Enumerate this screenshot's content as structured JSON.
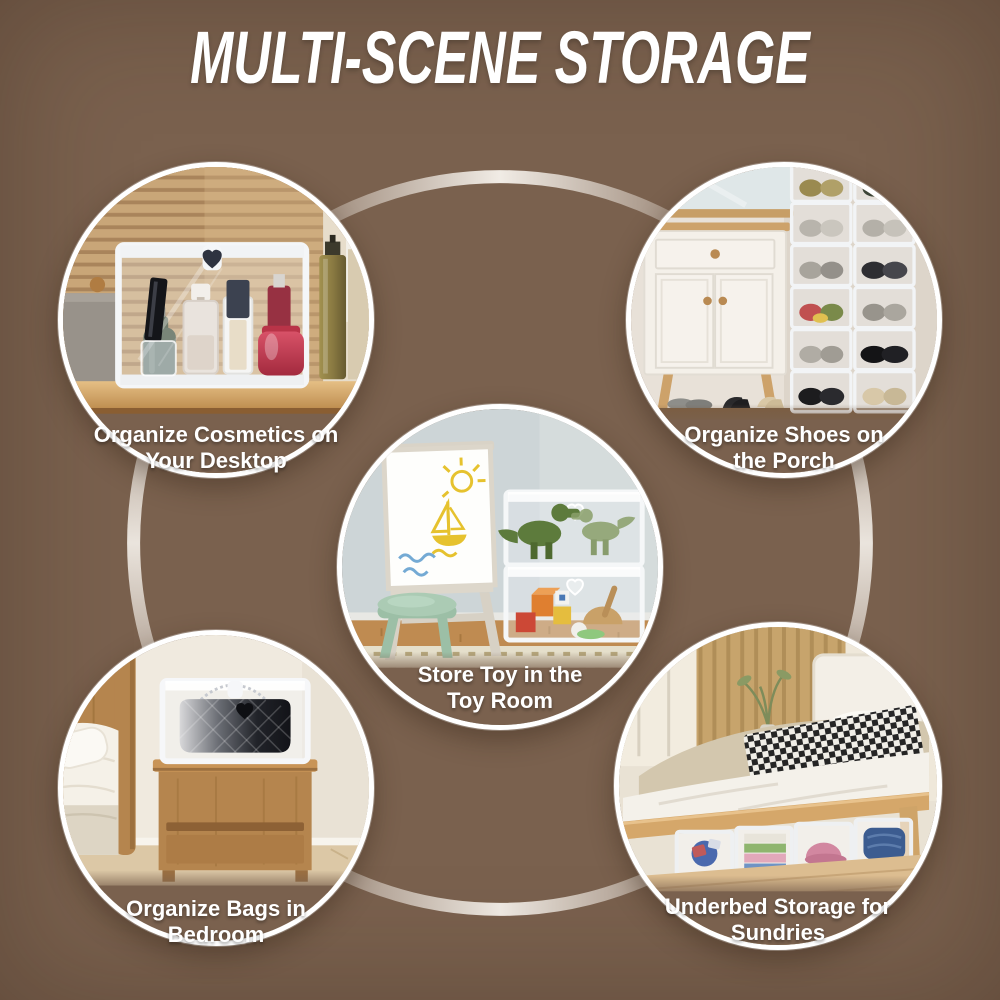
{
  "page": {
    "title": "MULTI-SCENE STORAGE",
    "background_color": "#7a614e",
    "text_color": "#ffffff"
  },
  "decor": {
    "ring_color": "#f2ece4",
    "circle_border_color": "#ffffff"
  },
  "scenes": [
    {
      "name": "cosmetics-desktop",
      "caption_line1": "Organize Cosmetics on",
      "caption_line2": "Your Desktop"
    },
    {
      "name": "shoes-porch",
      "caption_line1": "Organize Shoes on",
      "caption_line2": "the Porch"
    },
    {
      "name": "toy-room",
      "caption_line1": "Store Toy in the",
      "caption_line2": "Toy Room"
    },
    {
      "name": "bags-bedroom",
      "caption_line1": "Organize Bags in",
      "caption_line2": "Bedroom"
    },
    {
      "name": "underbed-sundries",
      "caption_line1": "Underbed Storage for",
      "caption_line2": "Sundries"
    }
  ]
}
